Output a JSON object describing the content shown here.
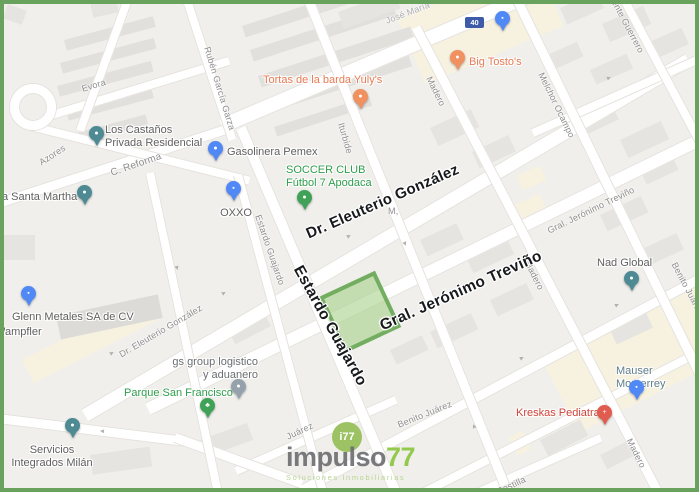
{
  "colors": {
    "frame": "#68a25c",
    "map_background": "#f0efec",
    "road": "#ffffff",
    "building": "#e6e4e1",
    "commercial_area": "#f7f1e0",
    "plot_fill": "#a7d188",
    "plot_stroke": "#69a758",
    "i77_marker_bg": "#9cc263"
  },
  "badge": {
    "label": "40",
    "bg": "#3d5ba9"
  },
  "logo": {
    "main": "impulso",
    "accent": "77",
    "tagline": "Soluciones Inmobiliarias",
    "marker": "i77",
    "main_color": "#6e6f72",
    "accent_color": "#8cc63f",
    "tagline_color": "#b5d48c"
  },
  "bold_streets": [
    {
      "text": "Dr. Eleuterio González"
    },
    {
      "text": "Estardo Guajardo"
    },
    {
      "text": "Gral. Jerónimo Treviño"
    }
  ],
  "streets": [
    {
      "text": "Evora"
    },
    {
      "text": "Azores"
    },
    {
      "text": "Rubén García Garza"
    },
    {
      "text": "José María"
    },
    {
      "text": "C. Reforma"
    },
    {
      "text": "Iturbide"
    },
    {
      "text": "Madero"
    },
    {
      "text": "Melchor Ocampo"
    },
    {
      "text": "Vicente Guerrero"
    },
    {
      "text": "Estardo Guajardo"
    },
    {
      "text": "Dr. Eleuterio González"
    },
    {
      "text": "Gral. Jerónimo Treviño"
    },
    {
      "text": "Madero"
    },
    {
      "text": "Benito Juárez"
    },
    {
      "text": "Juárez"
    },
    {
      "text": "Costilla"
    },
    {
      "text": "Madero"
    },
    {
      "text": "M,"
    },
    {
      "text": "Benito Juárez"
    }
  ],
  "pois": [
    {
      "text": "Tortas de la barda Yuly's",
      "color": "#e87a54",
      "pin": "#f0915f",
      "glyph": "●"
    },
    {
      "text": "Big Tosto's",
      "color": "#e87a54",
      "pin": "#f0915f",
      "glyph": "●"
    },
    {
      "text": "",
      "color": "#5f6368",
      "pin": "#5088f5",
      "glyph": "▪"
    },
    {
      "text": "Los Castaños\nPrivada Residencial",
      "color": "#616161",
      "pin": "#4d8a93",
      "glyph": "●"
    },
    {
      "text": "a Santa Martha",
      "color": "#616161",
      "pin": "#4d8a93",
      "glyph": "●"
    },
    {
      "text": "Gasolinera Pemex",
      "color": "#616161",
      "pin": "#5088f5",
      "glyph": "●"
    },
    {
      "text": "OXXO",
      "color": "#616161",
      "pin": "#5088f5",
      "glyph": "▪"
    },
    {
      "text": "SOCCER CLUB\nFútbol 7 Apodaca",
      "color": "#2f9e4c",
      "pin": "#3fa257",
      "glyph": "●"
    },
    {
      "text": "Glenn Metales SA de CV",
      "color": "#616161",
      "pin": "#5088f5",
      "glyph": "▪"
    },
    {
      "text": "Wampfler",
      "color": "#616161",
      "pin": "",
      "glyph": ""
    },
    {
      "text": "gs group logistico\ny aduanero",
      "color": "#6b6f71",
      "pin": "#95a2ab",
      "glyph": "●"
    },
    {
      "text": "Parque San Francisco",
      "color": "#2f9e4c",
      "pin": "#3fa257",
      "glyph": "♣"
    },
    {
      "text": "Servicios\nIntegrados Milán",
      "color": "#616161",
      "pin": "#4d8a93",
      "glyph": "●"
    },
    {
      "text": "Nad Global",
      "color": "#616161",
      "pin": "#4d8a93",
      "glyph": "●"
    },
    {
      "text": "Mauser Monterrey",
      "color": "#5f7d8c",
      "pin": "#5088f5",
      "glyph": "▪"
    },
    {
      "text": "Kreskas Pediatra",
      "color": "#cf4339",
      "pin": "#e25b4f",
      "glyph": "+"
    }
  ]
}
